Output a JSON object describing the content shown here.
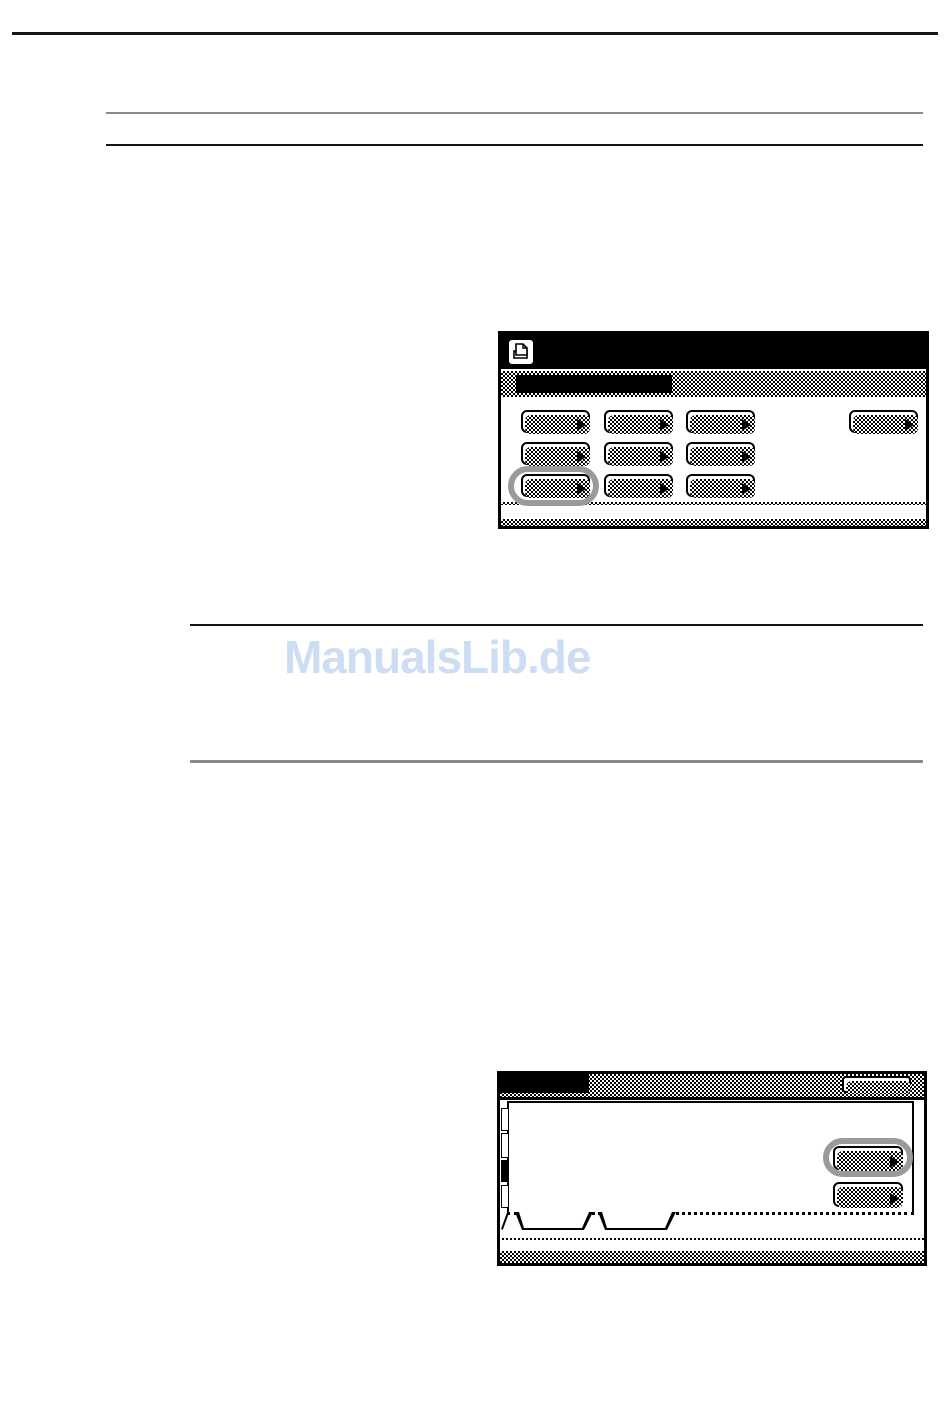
{
  "watermark": {
    "text": "ManualsLib.de",
    "color": "#cdddf3"
  },
  "colors": {
    "annotation_ring": "#9a9a9a",
    "screen_bar": "#000000",
    "rule_dark": "#161616",
    "rule_gray": "#8a8a8a"
  },
  "screen1": {
    "icon": "printer-icon",
    "title_bar_label": "",
    "menu_buttons": [
      {
        "label": ""
      },
      {
        "label": ""
      },
      {
        "label": ""
      },
      {
        "label": ""
      },
      {
        "label": ""
      },
      {
        "label": ""
      },
      {
        "label": ""
      },
      {
        "label": ""
      },
      {
        "label": ""
      }
    ],
    "side_button": {
      "label": ""
    },
    "highlight": {
      "type": "ring",
      "target": "menu-button-7"
    }
  },
  "screen2": {
    "title_bar_label": "",
    "header_button": {
      "label": ""
    },
    "left_tabs": [
      {
        "selected": false
      },
      {
        "selected": false
      },
      {
        "selected": true
      },
      {
        "selected": false
      }
    ],
    "panel_buttons": [
      {
        "label": ""
      },
      {
        "label": ""
      }
    ],
    "bottom_tabs": [
      {
        "label": ""
      },
      {
        "label": ""
      }
    ],
    "highlight": {
      "type": "ring",
      "target": "panel-button-1"
    }
  }
}
